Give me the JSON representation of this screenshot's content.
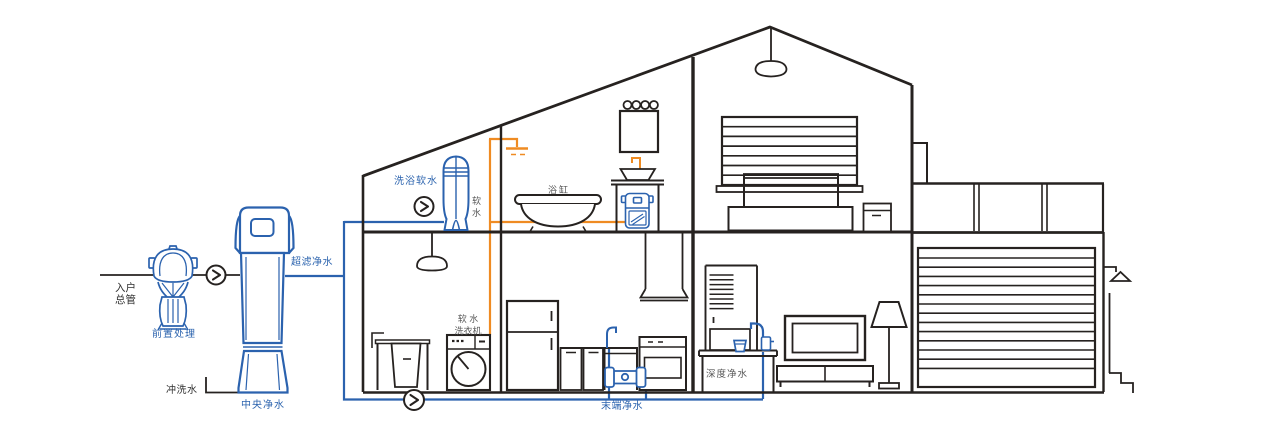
{
  "diagram": {
    "labels": {
      "inlet_main": "入户\n总管",
      "pre_treatment": "前置处理",
      "central_purifier": "中央净水",
      "flush_water": "冲洗水",
      "ultrafiltration": "超滤净水",
      "bath_soft_water": "洗浴软水",
      "soft_water": "软水",
      "bathtub": "浴缸",
      "soft_water_washer": "软 水\n洗衣机",
      "terminal_purifier": "末端净水",
      "deep_purifier": "深度净水"
    },
    "colors": {
      "purified_pipe_blue": "#2b62ae",
      "soft_water_pipe_orange": "#ef8b22",
      "structure_dark": "#262220",
      "label_gray": "#575757"
    },
    "icons": {
      "flow_arrow": "chevron-right-in-circle"
    }
  }
}
